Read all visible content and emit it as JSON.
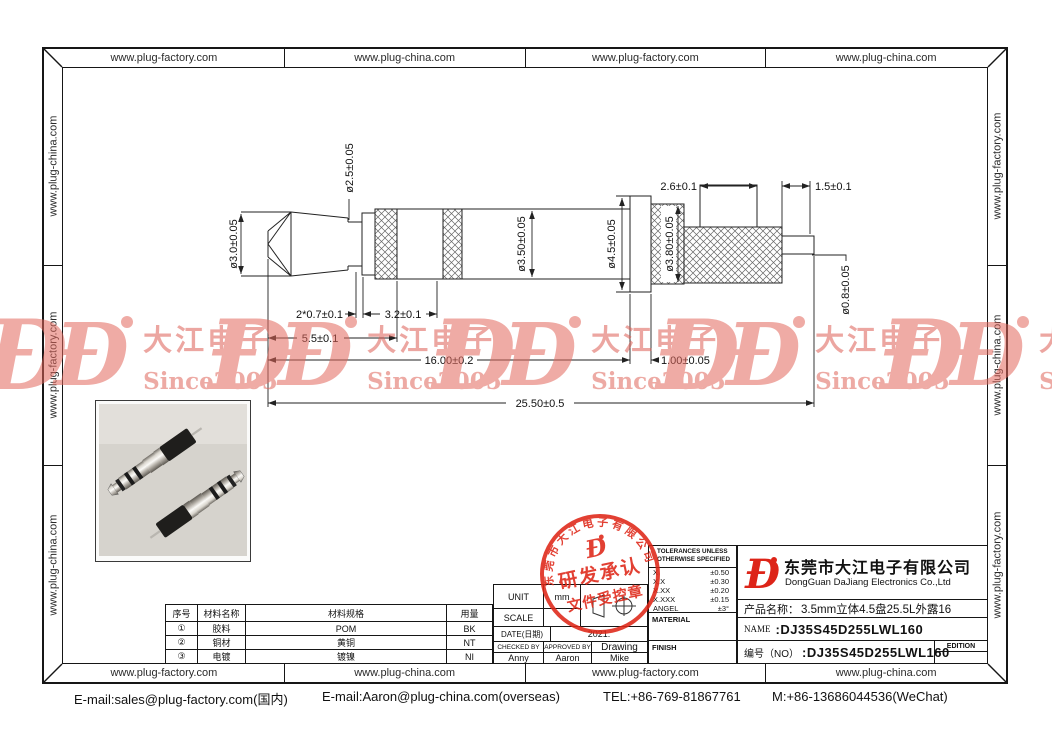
{
  "urls": {
    "factory": "www.plug-factory.com",
    "china": "www.plug-china.com"
  },
  "watermark": {
    "glyph": "Ð",
    "brand": "大江电子",
    "since": "Since2005"
  },
  "stamp": {
    "arc": "东莞市大江电子有限公司",
    "glyph": "Ð",
    "row1": "研发承认",
    "row2": "文件受控章"
  },
  "drawing": {
    "dims": {
      "tip_dia": "ø3.0±0.05",
      "neck_dia": "ø2.5±0.05",
      "groove": "2*0.7±0.1",
      "insulator": "3.2±0.1",
      "tip_len": "5.5±0.1",
      "barrel_dia": "ø3.50±0.05",
      "len_16": "16.00±0.2",
      "flange_dia": "ø4.5±0.05",
      "flange_w": "1.00±0.05",
      "rear_dia": "ø3.80±0.05",
      "rear_len": "2.6±0.1",
      "pin_len": "1.5±0.1",
      "pin_dia": "ø0.8±0.05",
      "total_len": "25.50±0.5"
    }
  },
  "material_table": {
    "headers": [
      "序号",
      "材料名称",
      "材料规格",
      "用量"
    ],
    "rows": [
      {
        "no": "①",
        "name": "胶料",
        "spec": "POM",
        "qty": "BK"
      },
      {
        "no": "②",
        "name": "铜材",
        "spec": "黄铜",
        "qty": "NT"
      },
      {
        "no": "③",
        "name": "电镀",
        "spec": "镀镍",
        "qty": "NI"
      }
    ]
  },
  "info_table": {
    "unit_label": "UNIT",
    "unit_value": "mm",
    "scale_label": "SCALE",
    "date_label": "DATE(日期)",
    "date_value": "2021.",
    "checked_label": "CHECKED BY",
    "approved_label": "APPROVED BY",
    "drawing_label": "Drawing",
    "checked_by": "Anny",
    "approved_by": "Aaron",
    "drawn_by": "Mike"
  },
  "tolerances": {
    "title_line1": "TOLERANCES UNLESS",
    "title_line2": "OTHERWISE SPECIFIED",
    "rows": [
      {
        "label": "X",
        "value": "±0.50"
      },
      {
        "label": "X.X",
        "value": "±0.30"
      },
      {
        "label": "X.XX",
        "value": "±0.20"
      },
      {
        "label": "X.XXX",
        "value": "±0.15"
      },
      {
        "label": "ANGEL",
        "value": "±3°"
      }
    ],
    "material_label": "MATERIAL",
    "finish_label": "FINISH"
  },
  "title_block": {
    "company_cn": "东莞市大江电子有限公司",
    "company_en": "DongGuan DaJiang Electronics Co.,Ltd",
    "product_label": "产品名称：",
    "product_value": "3.5mm立体4.5盘25.5L外露16",
    "name_label": "NAME",
    "name_value": ":DJ35S45D255LWL160",
    "no_label": "编号（NO）",
    "no_value": ":DJ35S45D255LWL160",
    "edition_label": "EDITION"
  },
  "footer": {
    "email_domestic": "E-mail:sales@plug-factory.com(国内)",
    "email_overseas": "E-mail:Aaron@plug-china.com(overseas)",
    "tel": "TEL:+86-769-81867761",
    "mobile": "M:+86-13686044536(WeChat)"
  }
}
